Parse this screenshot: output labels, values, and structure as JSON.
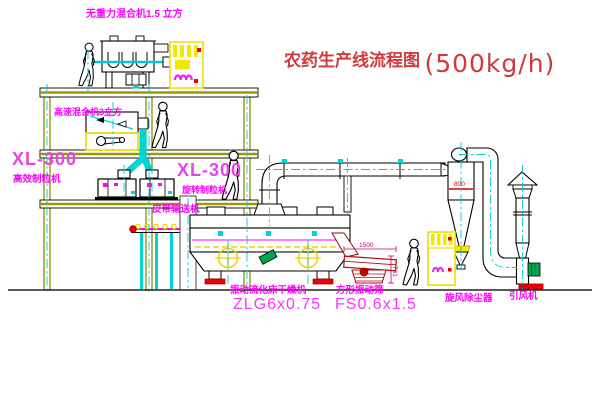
{
  "title": {
    "text": "农药生产线流程图",
    "capacity": "(500kg/h)"
  },
  "equipment": {
    "gravity_mixer": {
      "label": "无重力混合机1.5 立方"
    },
    "high_speed_mixer": {
      "label": "高速混合机3立方"
    },
    "granulator_left": {
      "model": "XL-300",
      "name": "高效制粒机"
    },
    "granulator_right": {
      "model": "XL-300",
      "name": "旋转制粒机"
    },
    "belt_conveyor": {
      "label": "皮带输送机"
    },
    "dryer": {
      "name": "振动流化床干燥机",
      "model": "ZLG6x0.75"
    },
    "screen": {
      "name": "方形振动筛",
      "model": "FS0.6x1.5",
      "dim_length": "1500",
      "dim_height": "741"
    },
    "cyclone": {
      "label": "旋风除尘器",
      "dim": "800"
    },
    "fan": {
      "label": "引风机"
    }
  },
  "colors": {
    "label_magenta": "#ff00ff",
    "title_red": "#cf3a3a",
    "structure_olive": "#8f8f00",
    "centerline_cyan": "#00cccc",
    "cabinet_yellow": "#f5e800",
    "chute_cyan": "#00d5d5",
    "screen_dark_red": "#aa1111",
    "motor_green": "#00a550",
    "base_red": "#ee0000"
  }
}
